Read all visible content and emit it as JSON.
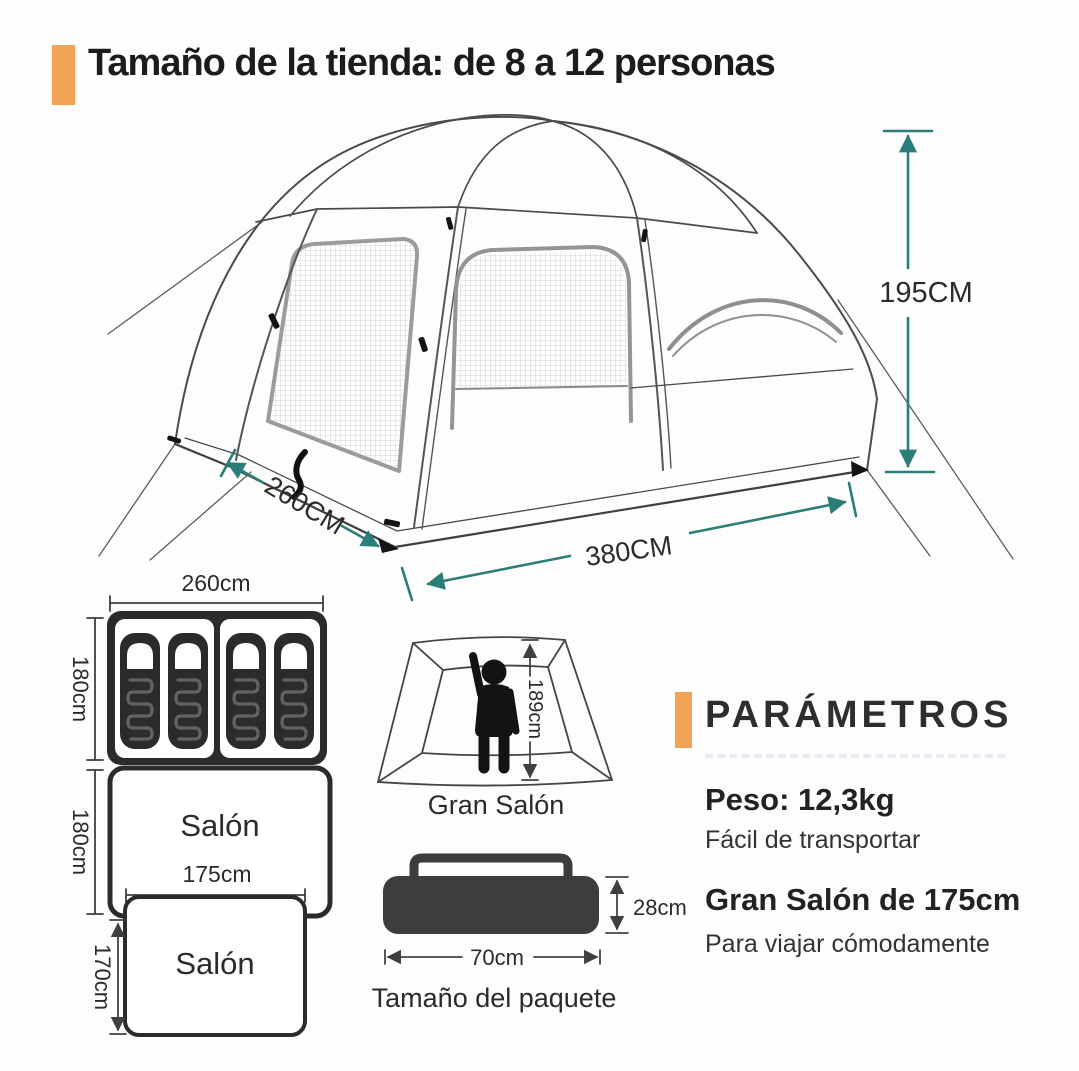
{
  "header": {
    "title": "Tamaño de la tienda: de 8 a 12 personas"
  },
  "tent": {
    "height_label": "195CM",
    "depth_label": "260CM",
    "width_label": "380CM"
  },
  "floor_plan": {
    "width_label": "260cm",
    "bedroom_depth_label": "180cm",
    "salon": {
      "label": "Salón",
      "depth_label": "180cm",
      "inner_width_label": "175cm"
    },
    "salon_front": {
      "label": "Salón",
      "depth_label": "170cm"
    }
  },
  "gran_salon": {
    "caption": "Gran Salón",
    "height_label": "189cm"
  },
  "package": {
    "caption": "Tamaño del paquete",
    "width_label": "70cm",
    "height_label": "28cm"
  },
  "parameters": {
    "heading": "PARÁMETROS",
    "weight": {
      "title": "Peso: 12,3kg",
      "subtitle": "Fácil de transportar"
    },
    "salon": {
      "title": "Gran Salón de 175cm",
      "subtitle": "Para viajar cómodamente"
    }
  },
  "colors": {
    "accent_orange": "#f0a355",
    "dimension_teal": "#2b7d78",
    "line_gray": "#4a4a4a",
    "bag_dark": "#2b2b2b",
    "ink": "#262626"
  }
}
